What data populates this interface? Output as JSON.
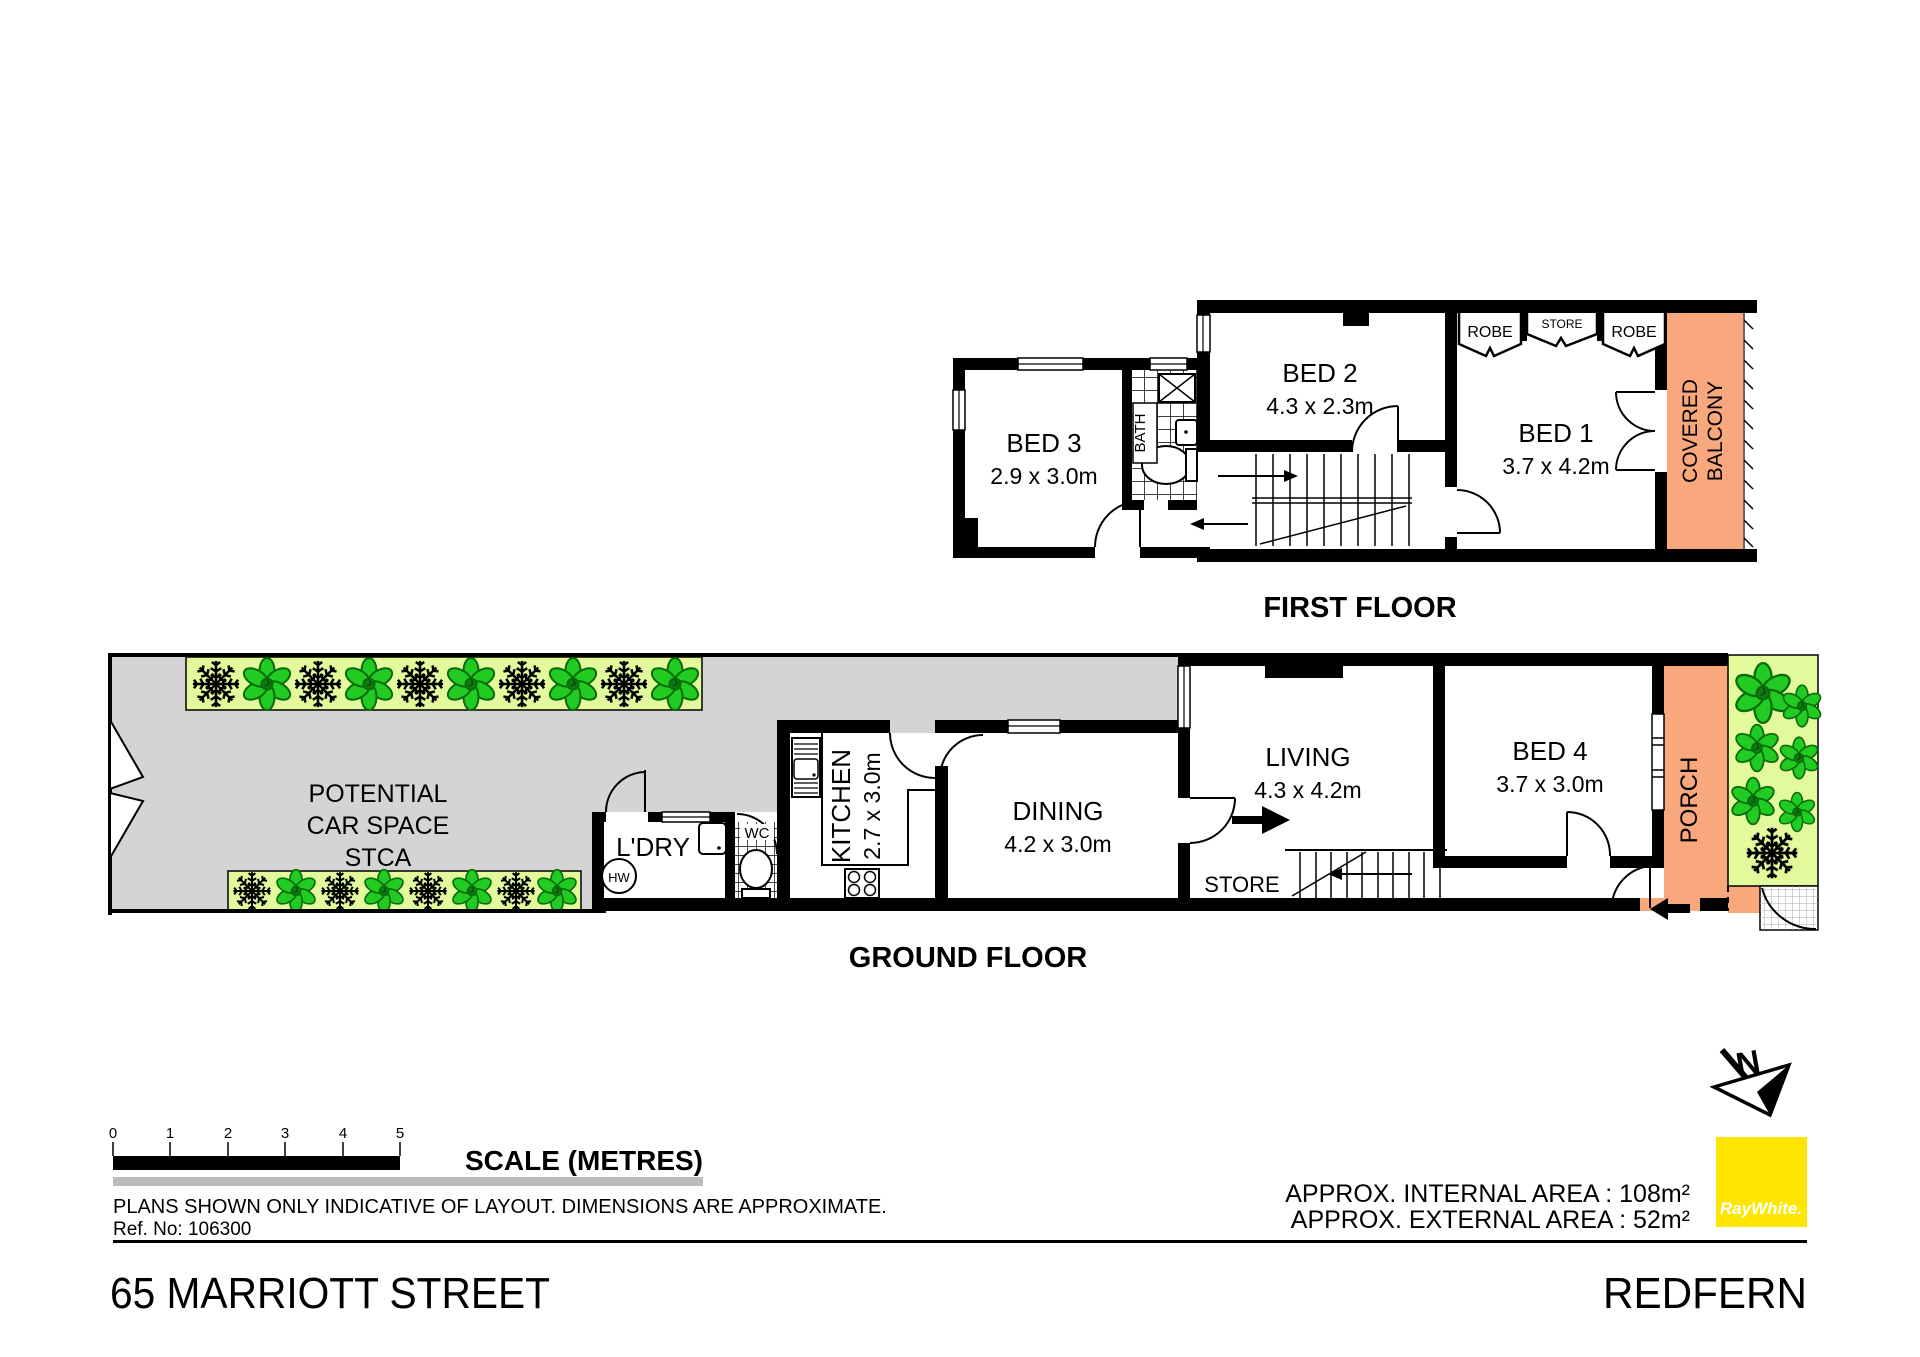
{
  "colors": {
    "driveway": "#D4D4D4",
    "garden_bed": "#E3FA9C",
    "balcony": "#F8A87C",
    "brand_yellow": "#FFE600",
    "flower_green": "#21CB21",
    "divider_gray": "#BBBBBB"
  },
  "first_floor": {
    "caption": "FIRST FLOOR",
    "bed1_name": "BED 1",
    "bed1_dims": "3.7 x 4.2m",
    "bed2_name": "BED 2",
    "bed2_dims": "4.3 x 2.3m",
    "bed3_name": "BED 3",
    "bed3_dims": "2.9 x 3.0m",
    "bath_label": "BATH",
    "robe_left": "ROBE",
    "store_label": "STORE",
    "robe_right": "ROBE",
    "balcony_line1": "COVERED",
    "balcony_line2": "BALCONY"
  },
  "ground_floor": {
    "caption": "GROUND FLOOR",
    "carspace_line1": "POTENTIAL",
    "carspace_line2": "CAR SPACE",
    "carspace_line3": "STCA",
    "laundry_label": "L'DRY",
    "hot_water_label": "HW",
    "wc_label": "WC",
    "kitchen_name": "KITCHEN",
    "kitchen_dims": "2.7 x 3.0m",
    "dining_name": "DINING",
    "dining_dims": "4.2 x 3.0m",
    "living_name": "LIVING",
    "living_dims": "4.3 x 4.2m",
    "store_label": "STORE",
    "bed4_name": "BED 4",
    "bed4_dims": "3.7 x 3.0m",
    "porch_label": "PORCH"
  },
  "scale_bar": {
    "label": "SCALE (METRES)",
    "ticks": [
      "0",
      "1",
      "2",
      "3",
      "4",
      "5"
    ]
  },
  "notes": {
    "disclaimer": "PLANS SHOWN ONLY INDICATIVE OF LAYOUT.  DIMENSIONS ARE APPROXIMATE.",
    "ref_no": "Ref. No: 106300"
  },
  "areas": {
    "internal": "APPROX. INTERNAL AREA : 108m²",
    "external": "APPROX. EXTERNAL AREA : 52m²"
  },
  "compass": {
    "north_label": "N"
  },
  "brand": {
    "logo_text": "RayWhite."
  },
  "footer": {
    "street": "65 MARRIOTT STREET",
    "suburb": "REDFERN"
  }
}
